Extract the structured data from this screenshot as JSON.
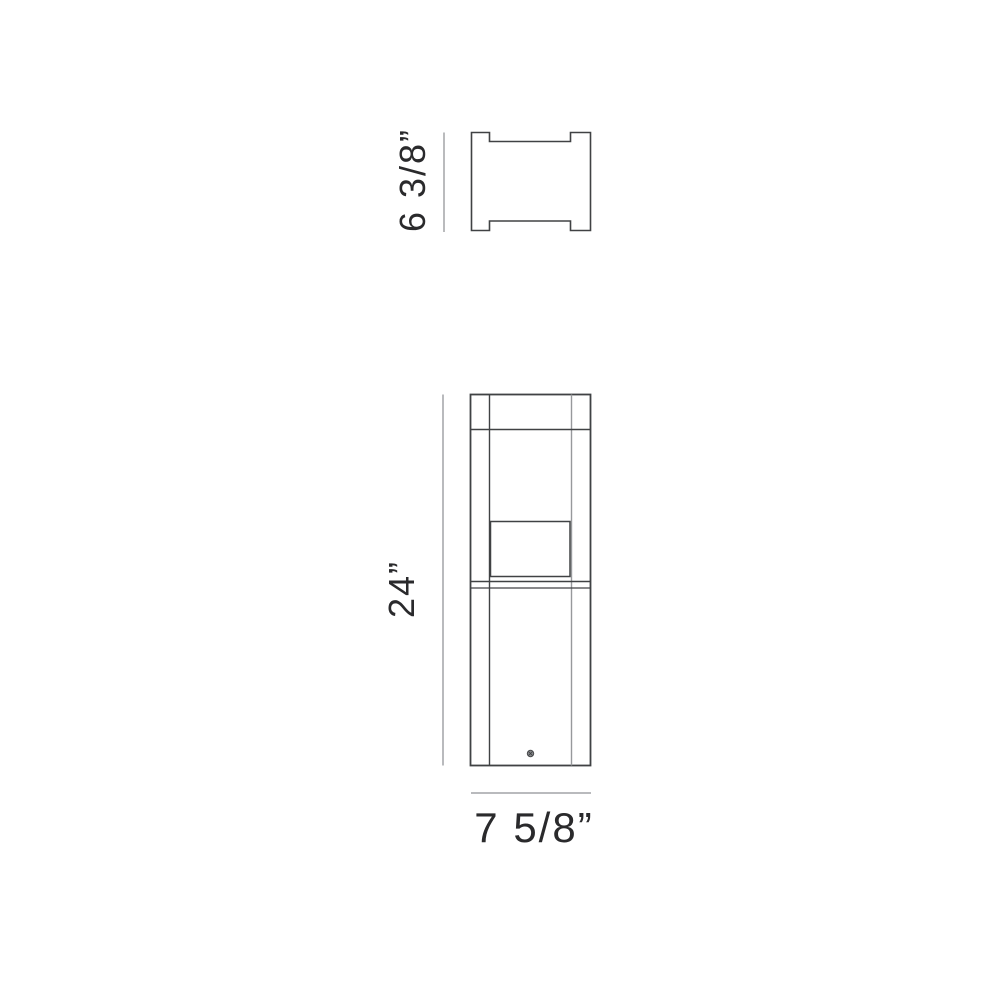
{
  "page": {
    "background": "#ffffff",
    "content": "product-dimension-drawing"
  },
  "diagram": {
    "views": [
      {
        "id": "top-view",
        "description": "top profile with corner tabs"
      },
      {
        "id": "front-view",
        "description": "bollard front elevation with lamp aperture and base screw"
      }
    ],
    "dimensions": {
      "top_view_height": {
        "label": "6 3/8”"
      },
      "front_view_height": {
        "label": "24”"
      },
      "front_view_width": {
        "label": "7 5/8”"
      }
    },
    "colors": {
      "outline": "#404244",
      "outline_light": "#97999c",
      "dimension_line": "#a2a4a7",
      "label_text": "#2a2a2c",
      "background": "#ffffff"
    }
  }
}
